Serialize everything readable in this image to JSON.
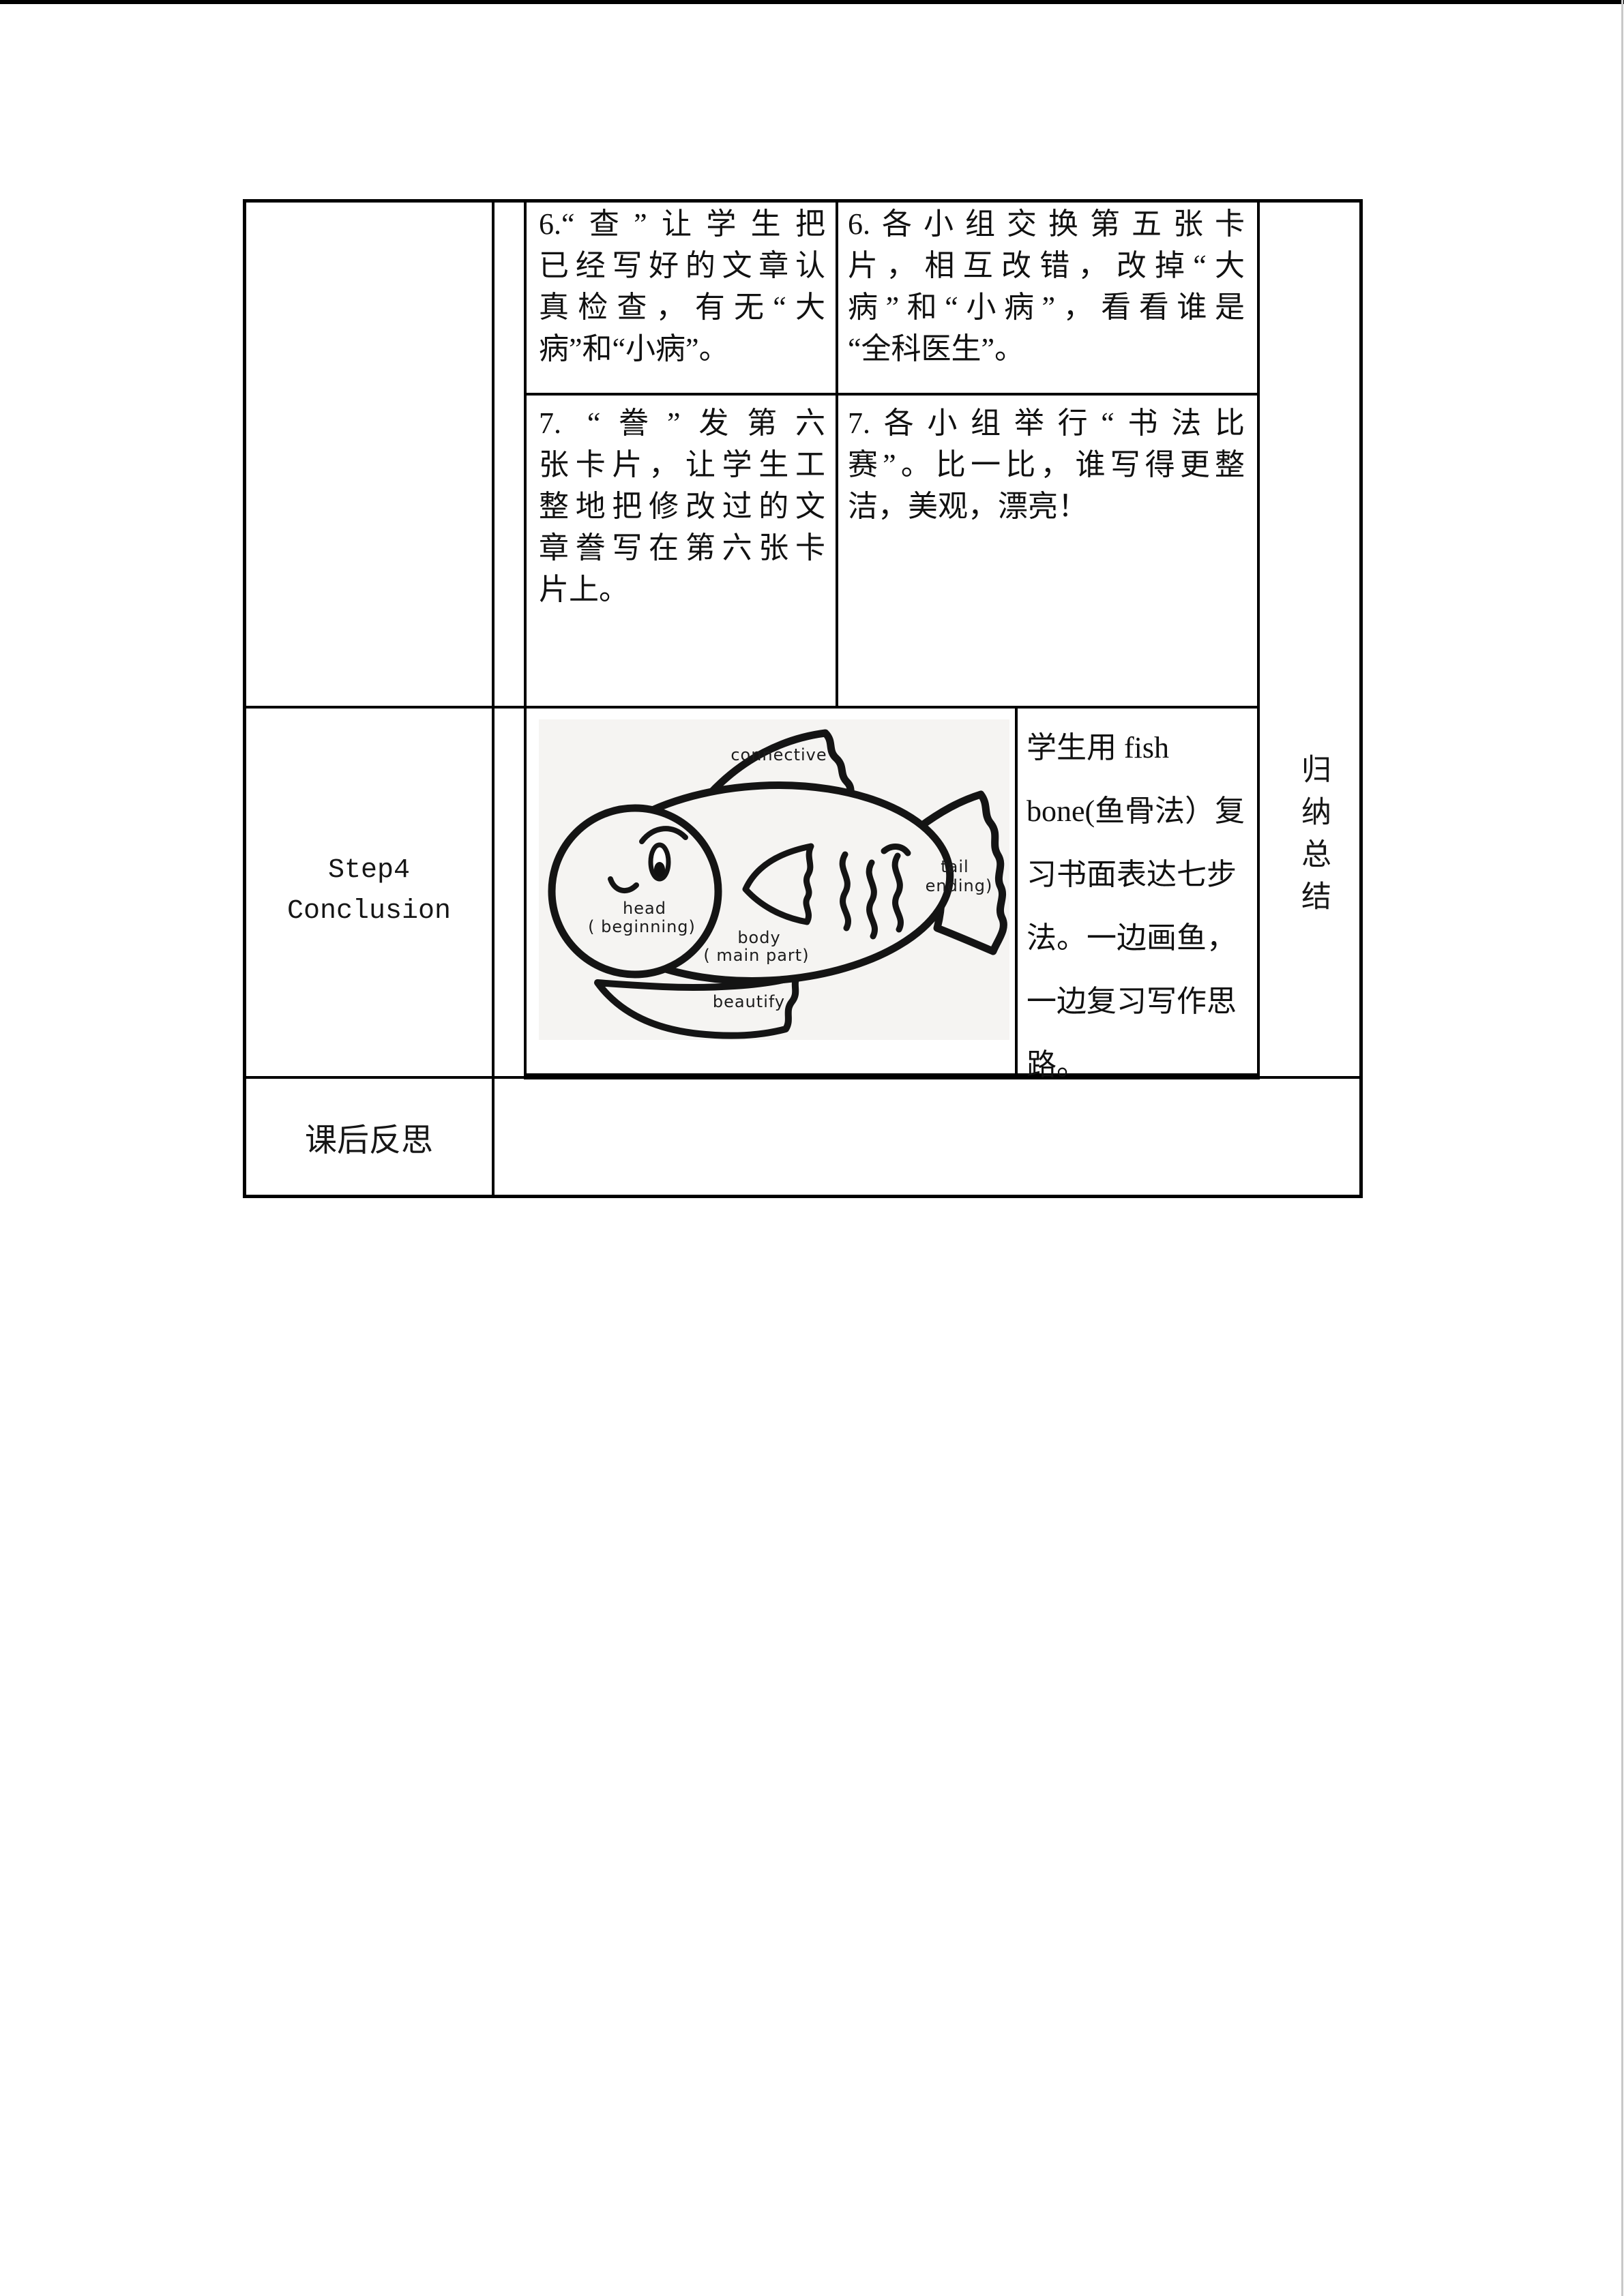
{
  "colors": {
    "border": "#000000",
    "text": "#111111",
    "page_top_bar": "#000000",
    "fish_bg": "#f5f4f2"
  },
  "cells": {
    "teacher_step6": {
      "lines": [
        "6.“查”让学生把",
        "已经写好的文章认",
        "真检查，有无“大",
        "病”和“小病”。"
      ]
    },
    "student_act6": {
      "lines": [
        "6.各小组交换第五张卡",
        "片，相互改错，改掉“大",
        "病”和“小病”，看看谁是",
        "“全科医生”。"
      ]
    },
    "teacher_step7": {
      "lines": [
        "7. “誊”发第六",
        "张卡片，让学生工",
        "整地把修改过的文",
        "章誊写在第六张卡",
        "片上。"
      ]
    },
    "student_act7": {
      "lines": [
        "7.各小组举行“书法比",
        "赛”。比一比，谁写得更整",
        "洁，美观，漂亮！"
      ]
    },
    "fish_note": {
      "lines": [
        "学生用 fish",
        "bone(鱼骨法）复",
        "习书面表达七步",
        "法。一边画鱼，",
        "一边复习写作思",
        "路。"
      ]
    },
    "step4": {
      "line1": "Step4",
      "line2": "Conclusion"
    },
    "summary_vertical": "归纳总结",
    "reflection": "课后反思"
  },
  "fish_diagram": {
    "labels": {
      "dorsal": "connective",
      "head_line1": "head",
      "head_line2": "( beginning)",
      "body_line1": "body",
      "body_line2": "( main part)",
      "tail_line1": "tail",
      "tail_line2": "ending)",
      "bottom": "beautify"
    }
  }
}
